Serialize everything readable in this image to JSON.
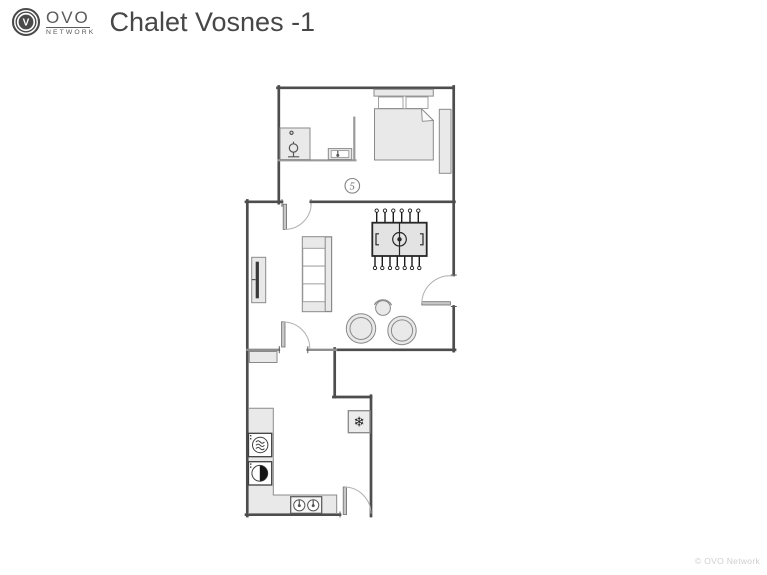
{
  "header": {
    "logo": {
      "mark_letter": "V",
      "brand": "OVO",
      "network": "NETWORK"
    },
    "title": "Chalet Vosnes -1"
  },
  "floorplan": {
    "room_label": "5",
    "icons": {
      "freezer": "❄"
    },
    "colors": {
      "wall": "#4d4d4d",
      "partition": "#8e8e8e",
      "furniture_fill": "#e9e9e9",
      "furniture_stroke": "#8a8a8a",
      "appliance_stroke": "#3f3f3f",
      "door_arc": "#b0b0b0",
      "tv_screen": "#3a3a3a"
    }
  },
  "footer": {
    "copyright": "© OVO Network"
  }
}
